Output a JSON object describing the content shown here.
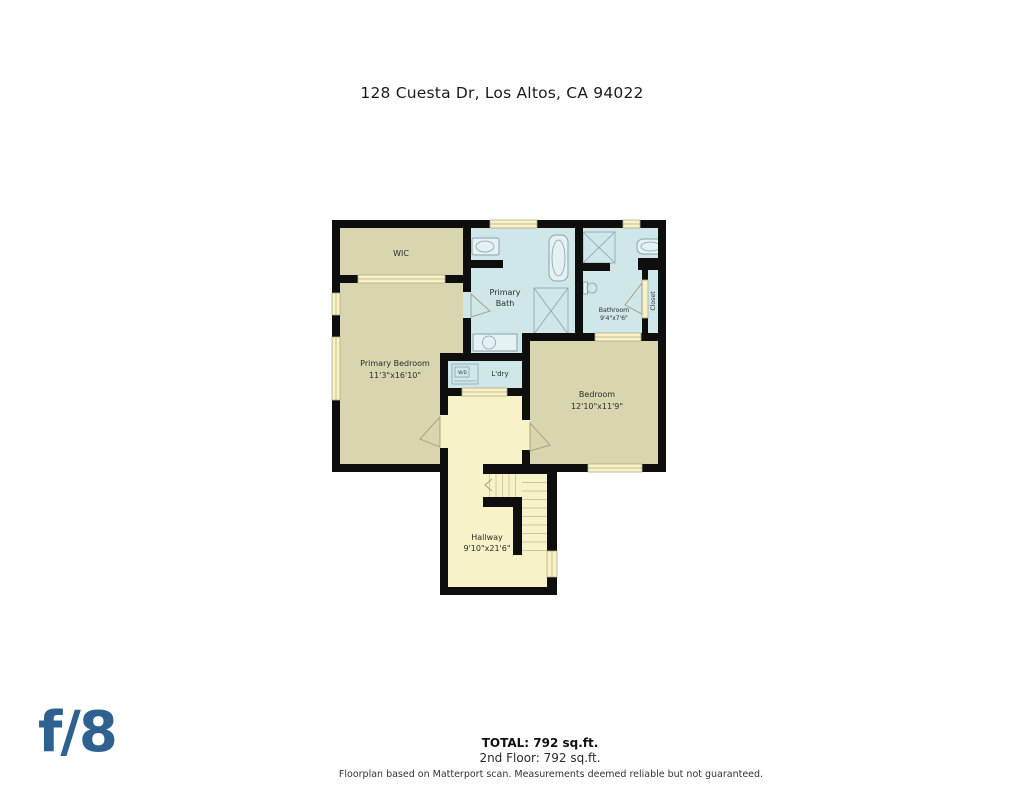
{
  "title": "128 Cuesta Dr, Los Altos, CA 94022",
  "palette": {
    "wall": "#0e0e0e",
    "tan": "#d9d5af",
    "blue": "#cfe7e9",
    "cream": "#f8f2c8",
    "window_line": "#b3ab85",
    "fixture_outline": "#8aa3ab",
    "label_text": "#2d2d2d",
    "logo_blue": "#2e6190"
  },
  "rooms": {
    "wic": {
      "label": "WIC"
    },
    "primary_bedroom": {
      "label": "Primary Bedroom",
      "dims": "11'3\"x16'10\""
    },
    "primary_bath": {
      "label_line1": "Primary",
      "label_line2": "Bath"
    },
    "bathroom": {
      "label": "Bathroom",
      "dims": "9'4\"x7'6\""
    },
    "closet": {
      "label": "Closet"
    },
    "laundry": {
      "label": "L'dry",
      "appliance": "W/D"
    },
    "bedroom": {
      "label": "Bedroom",
      "dims": "12'10\"x11'9\""
    },
    "hallway": {
      "label": "Hallway",
      "dims": "9'10\"x21'6\""
    }
  },
  "footer": {
    "total": "TOTAL: 792 sq.ft.",
    "floor": "2nd Floor: 792 sq.ft.",
    "disclaimer": "Floorplan based on Matterport scan. Measurements deemed reliable but not guaranteed."
  },
  "logo": {
    "text": "f/8"
  }
}
